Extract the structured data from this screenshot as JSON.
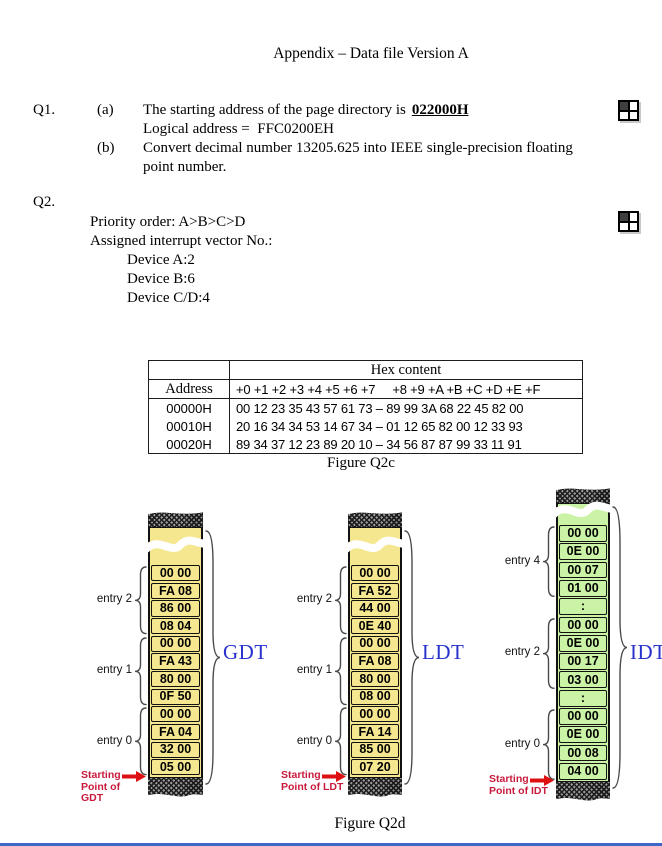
{
  "title": "Appendix – Data file Version A",
  "q1": {
    "number": "Q1.",
    "a": {
      "label": "(a)",
      "line1_prefix": "The starting address of the page directory is",
      "line1_value": "022000H",
      "line2": "Logical address =  FFC0200EH"
    },
    "b": {
      "label": "(b)",
      "line1": "Convert decimal number 13205.625 into IEEE single-precision floating",
      "line2": "point number."
    }
  },
  "q2": {
    "number": "Q2.",
    "priority_order": "Priority order: A>B>C>D",
    "assigned_heading": "Assigned interrupt vector No.:",
    "devices": [
      {
        "name": "Device A:",
        "vector": "2"
      },
      {
        "name": "Device B:",
        "vector": "6"
      },
      {
        "name": "Device C/D:",
        "vector": "4"
      }
    ]
  },
  "figure_q2c": {
    "caption": "Figure Q2c",
    "header_group": "Hex content",
    "col1_header": "Address",
    "offsets_header": "+0 +1 +2 +3 +4 +5 +6 +7     +8 +9 +A +B +C +D +E +F",
    "rows": [
      {
        "address": "00000H",
        "hex": "00 12 23 35 43 57 61 73 – 89 99 3A 68 22 45 82 00"
      },
      {
        "address": "00010H",
        "hex": "20 16 34 34 53 14 67 34 – 01 12 65 82 00 12 33 93"
      },
      {
        "address": "00020H",
        "hex": "89 34 37 12 23 89 20 10 – 34 56 87 87 99 33 11 91"
      }
    ]
  },
  "figure_q2d": {
    "caption": "Figure Q2d",
    "colors": {
      "descriptor_fill": "#F5E78F",
      "idt_fill": "#CBF3A5",
      "label_blue": "#2733CC",
      "start_red": "#C81A3C",
      "arrow_red": "#DD1111"
    },
    "tables": [
      {
        "name": "GDT",
        "cells": [
          "00 00",
          "FA 08",
          "86 00",
          "08 04",
          "00 00",
          "FA 43",
          "80 00",
          "0F 50",
          "00 00",
          "FA 04",
          "32 00",
          "05 00"
        ],
        "entries": [
          {
            "label": "entry 2",
            "from": 0,
            "to": 3
          },
          {
            "label": "entry 1",
            "from": 4,
            "to": 7
          },
          {
            "label": "entry 0",
            "from": 8,
            "to": 11
          }
        ],
        "start_lines": [
          "Starting",
          "Point of GDT"
        ]
      },
      {
        "name": "LDT",
        "cells": [
          "00 00",
          "FA 52",
          "44 00",
          "0E 40",
          "00 00",
          "FA 08",
          "80 00",
          "08 00",
          "00 00",
          "FA 14",
          "85 00",
          "07 20"
        ],
        "entries": [
          {
            "label": "entry 2",
            "from": 0,
            "to": 3
          },
          {
            "label": "entry 1",
            "from": 4,
            "to": 7
          },
          {
            "label": "entry 0",
            "from": 8,
            "to": 11
          }
        ],
        "start_lines": [
          "Starting",
          "Point of LDT"
        ]
      },
      {
        "name": "IDT",
        "cells": [
          "00 00",
          "0E 00",
          "00 07",
          "01 00",
          ":",
          "00 00",
          "0E 00",
          "00 17",
          "03 00",
          ":",
          "00 00",
          "0E 00",
          "00 08",
          "04 00"
        ],
        "entries": [
          {
            "label": "entry 4",
            "from": 0,
            "to": 3
          },
          {
            "label": "entry 2",
            "from": 5,
            "to": 8
          },
          {
            "label": "entry 0",
            "from": 10,
            "to": 13
          }
        ],
        "start_lines": [
          "Starting",
          "Point of IDT"
        ]
      }
    ]
  },
  "icons": {
    "q1_marker": "table-grid-icon",
    "q2_marker": "table-grid-icon"
  },
  "chrome": {
    "bottom_bar_color": "#3E66C9"
  }
}
